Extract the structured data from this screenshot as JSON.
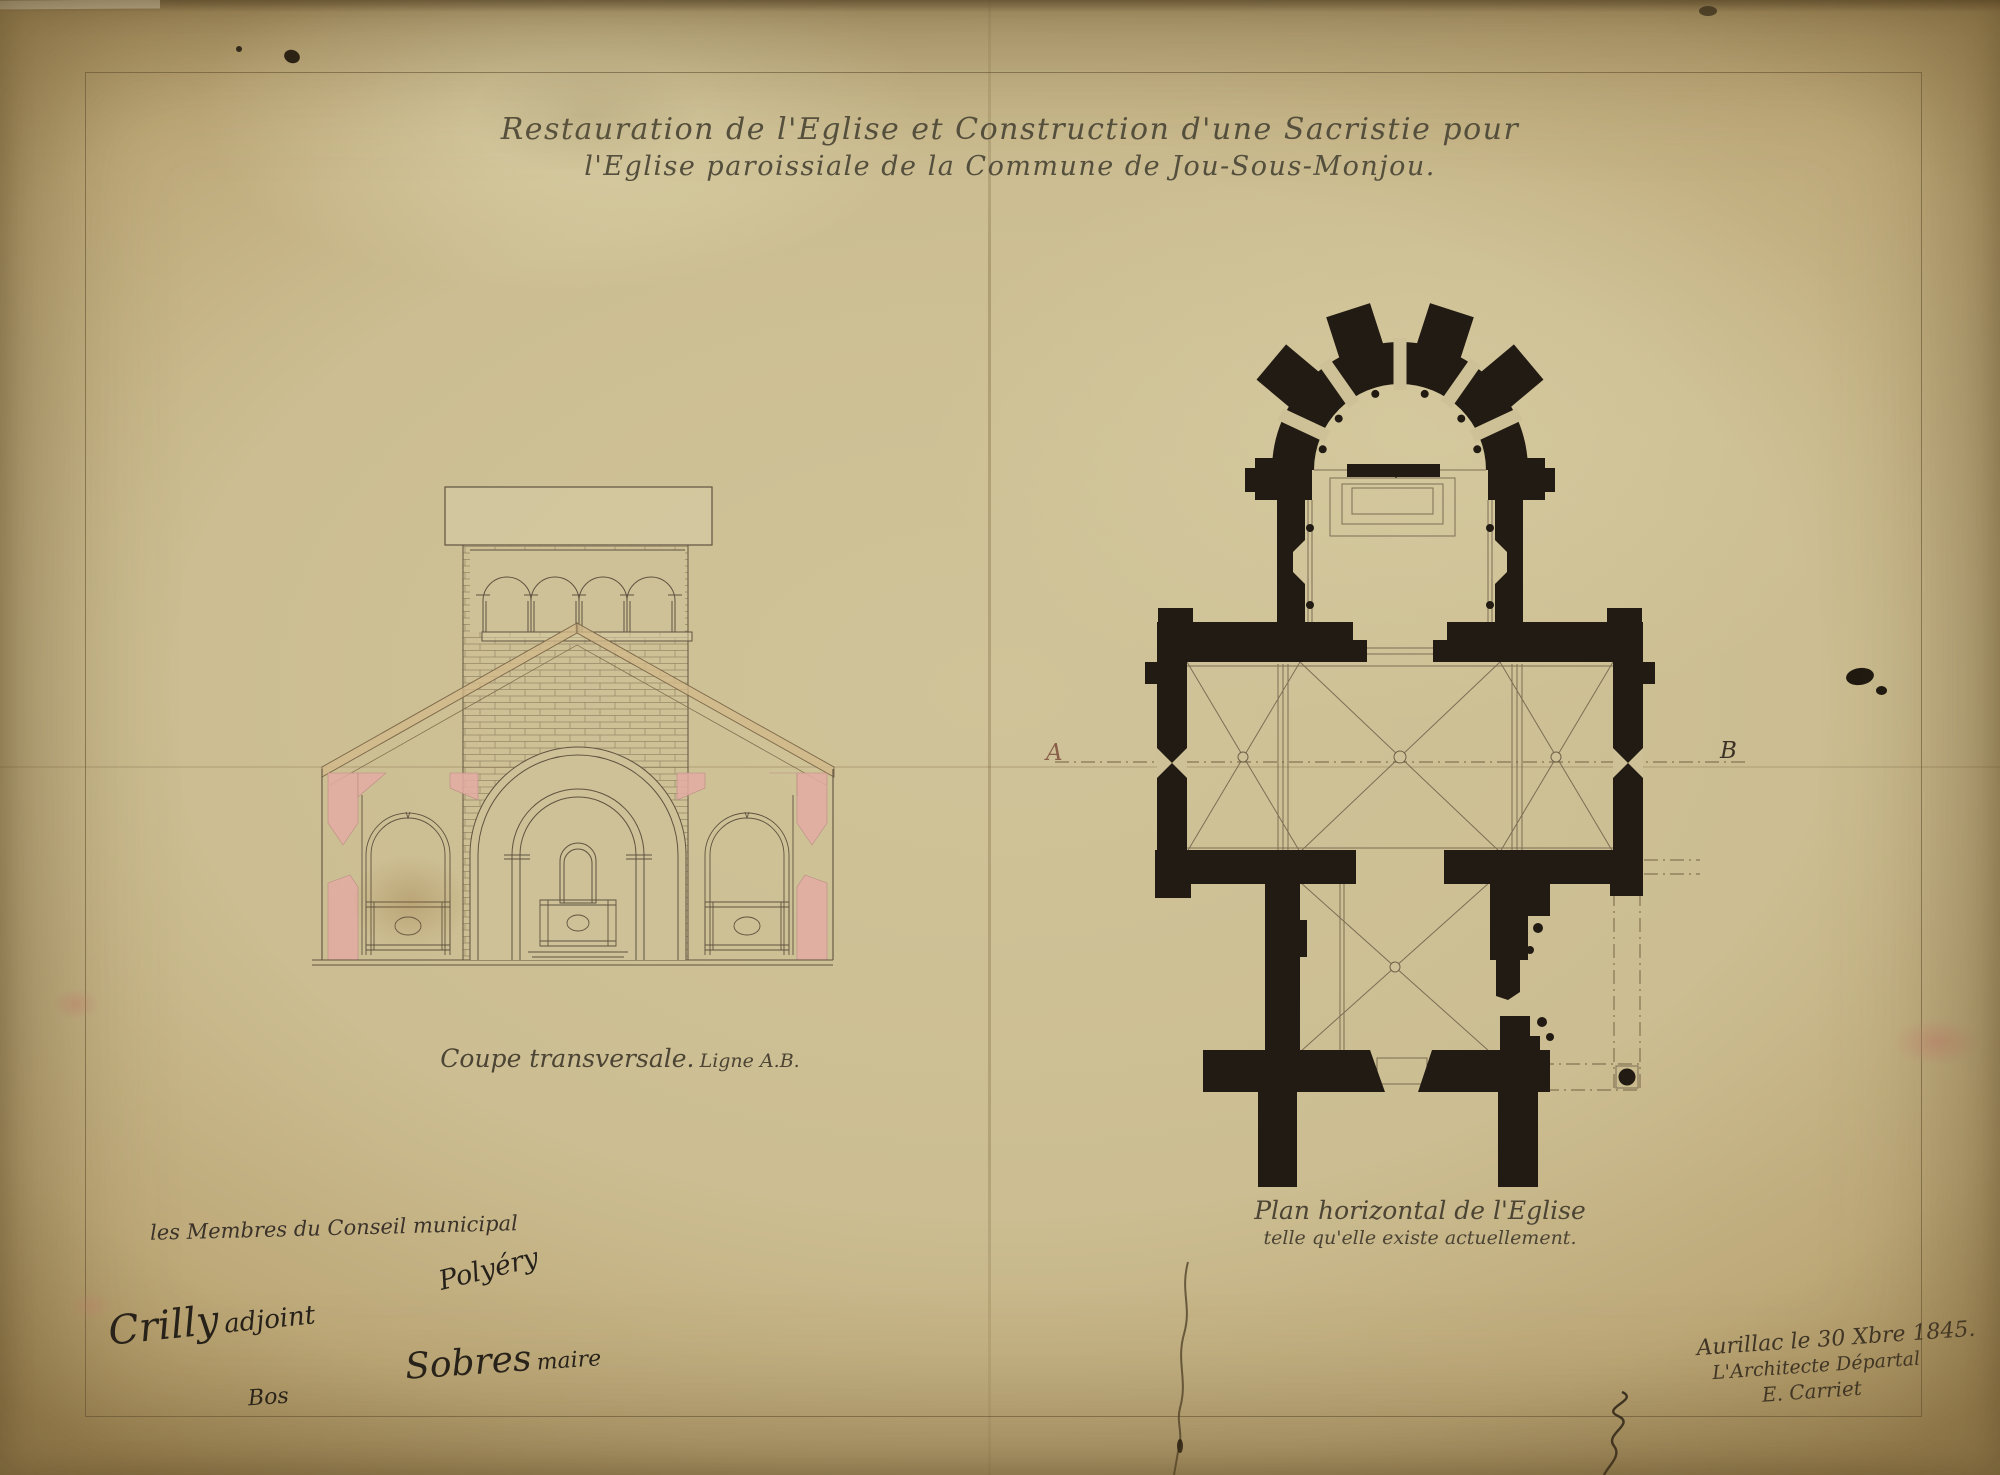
{
  "title": {
    "line1": "Restauration de l'Eglise et Construction d'une Sacristie pour",
    "line2": "l'Eglise paroissiale de la Commune de Jou-Sous-Monjou."
  },
  "section_view": {
    "caption": "Coupe transversale.",
    "caption_suffix": "Ligne A.B."
  },
  "plan_view": {
    "caption_line1": "Plan horizontal de l'Eglise",
    "caption_line2": "telle qu'elle existe actuellement.",
    "marker_left": "A",
    "marker_right": "B"
  },
  "approvals": {
    "heading": "les Membres du Conseil municipal",
    "signature_polyery": "Polyéry",
    "signature_adjoint_name": "Crilly",
    "signature_adjoint_role": "adjoint",
    "signature_bos": "Bos",
    "signature_maire_name": "Sobres",
    "signature_maire_role": "maire"
  },
  "colophon": {
    "place_date": "Aurillac le 30 Xbre 1845.",
    "role": "L'Architecte Départal",
    "signature": "E. Carriet"
  },
  "colors": {
    "paper": "#cec197",
    "ink_dark": "#211b13",
    "ink_line": "#6a5b43",
    "wash_pink": "#e3aca3",
    "wash_roof": "#d2b88a"
  }
}
